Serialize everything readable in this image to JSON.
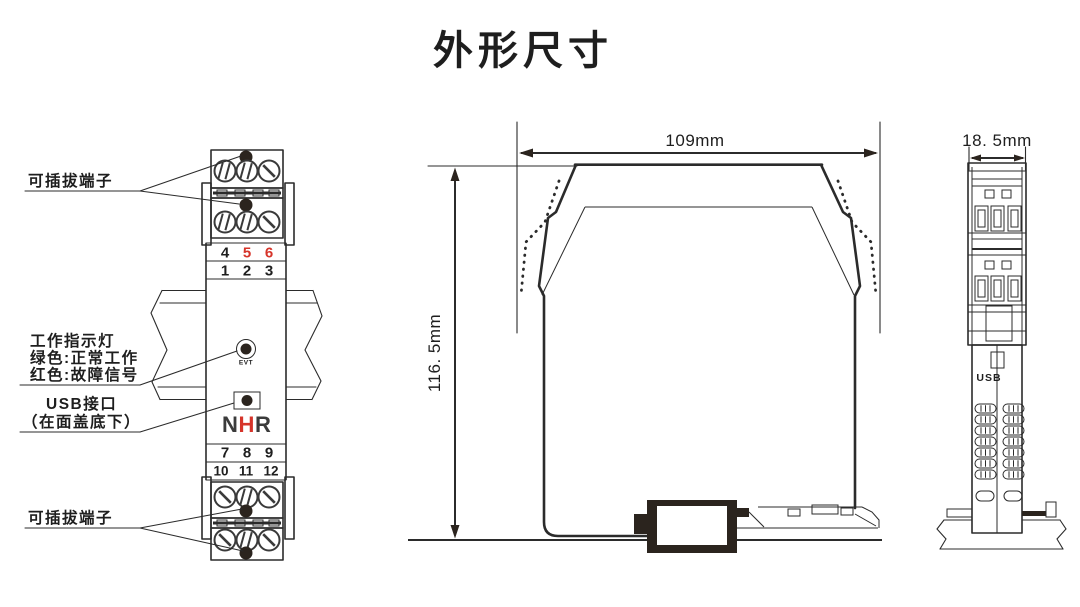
{
  "title": "外形尺寸",
  "colors": {
    "line": "#2b2b2b",
    "red": "#d6342a",
    "logo_dark": "#3b3b3b"
  },
  "front_view": {
    "top_terminal_label": "可插拔端子",
    "indicator_label_lines": [
      "工作指示灯",
      "绿色:正常工作",
      "红色:故障信号"
    ],
    "usb_label_lines": [
      "USB接口",
      "（在面盖底下）"
    ],
    "bottom_terminal_label": "可插拔端子",
    "terminal_rows": {
      "row_456": [
        "4",
        "5",
        "6"
      ],
      "row_456_colors": [
        "dark",
        "red",
        "red"
      ],
      "row_123": [
        "1",
        "2",
        "3"
      ],
      "row_789": [
        "7",
        "8",
        "9"
      ],
      "row_101112": [
        "10",
        "11",
        "12"
      ]
    },
    "indicator_text": "EVT",
    "logo_letters": [
      "N",
      "H",
      "R"
    ]
  },
  "side_view": {
    "width_dim": "109mm",
    "height_dim": "116. 5mm"
  },
  "end_view": {
    "width_dim": "18. 5mm",
    "usb_text": "USB"
  }
}
